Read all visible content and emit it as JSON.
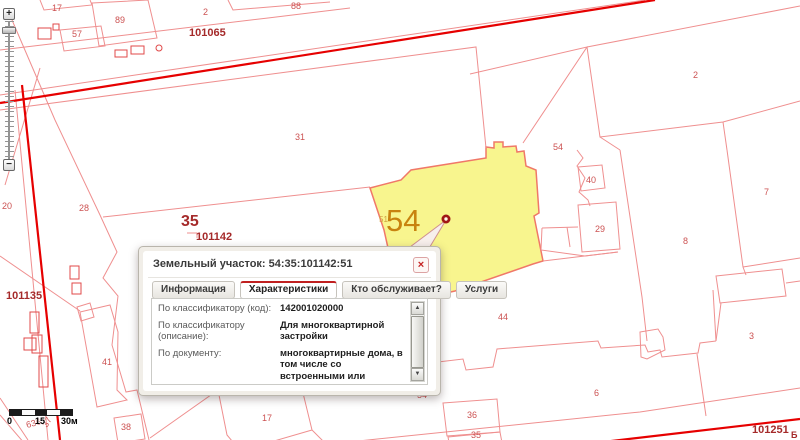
{
  "popup": {
    "title": "Земельный участок: 54:35:101142:51",
    "close_icon": "×",
    "tabs": [
      {
        "label": "Информация",
        "active": false
      },
      {
        "label": "Характеристики",
        "active": true
      },
      {
        "label": "Кто обслуживает?",
        "active": false
      },
      {
        "label": "Услуги",
        "active": false
      }
    ],
    "rows": [
      {
        "label": "По классификатору (код):",
        "value": "142001020000"
      },
      {
        "label": "По классификатору (описание):",
        "value": "Для многоквартирной застройки"
      },
      {
        "label": "По документу:",
        "value": "многоквартирные дома, в том числе со встроенными или встроенно-пристроенными помещениями общественного назначения, автостоянками"
      }
    ],
    "scroll_up_icon": "▲",
    "scroll_down_icon": "▼"
  },
  "zoom_control": {
    "zoom_in_label": "+",
    "zoom_out_label": "−"
  },
  "scale_bar": {
    "start": "0",
    "mid": "15",
    "end": "30м"
  },
  "map": {
    "colors": {
      "parcel_line": "#ef8f8f",
      "building_line": "#e04848",
      "road": "#e60000",
      "selected_fill": "#f8f58e",
      "selected_stroke": "#f07868",
      "marker": "#a01616"
    },
    "selected_parcel_number": "54",
    "labels": [
      {
        "t": "17",
        "x": 52,
        "y": 11,
        "cls": "s"
      },
      {
        "t": "89",
        "x": 115,
        "y": 23,
        "cls": "s"
      },
      {
        "t": "57",
        "x": 72,
        "y": 37,
        "cls": "s"
      },
      {
        "t": "2",
        "x": 203,
        "y": 15,
        "cls": "s"
      },
      {
        "t": "88",
        "x": 291,
        "y": 9,
        "cls": "s"
      },
      {
        "t": "101065",
        "x": 189,
        "y": 36,
        "cls": "q"
      },
      {
        "t": "31",
        "x": 295,
        "y": 140,
        "cls": "s"
      },
      {
        "t": "2",
        "x": 693,
        "y": 78,
        "cls": "s"
      },
      {
        "t": "54",
        "x": 553,
        "y": 150,
        "cls": "s"
      },
      {
        "t": "40",
        "x": 586,
        "y": 183,
        "cls": "s"
      },
      {
        "t": "29",
        "x": 595,
        "y": 232,
        "cls": "s"
      },
      {
        "t": "8",
        "x": 683,
        "y": 244,
        "cls": "s"
      },
      {
        "t": "7",
        "x": 764,
        "y": 195,
        "cls": "s"
      },
      {
        "t": "28",
        "x": 79,
        "y": 211,
        "cls": "s"
      },
      {
        "t": "20",
        "x": 2,
        "y": 209,
        "cls": "s"
      },
      {
        "t": "35",
        "x": 181,
        "y": 226,
        "cls": "q35"
      },
      {
        "t": "101142",
        "x": 196,
        "y": 240,
        "cls": "q"
      },
      {
        "t": "101135",
        "x": 6,
        "y": 299,
        "cls": "q"
      },
      {
        "t": "44",
        "x": 498,
        "y": 320,
        "cls": "s"
      },
      {
        "t": "3",
        "x": 749,
        "y": 339,
        "cls": "s"
      },
      {
        "t": "6",
        "x": 594,
        "y": 396,
        "cls": "s"
      },
      {
        "t": "36",
        "x": 467,
        "y": 418,
        "cls": "s"
      },
      {
        "t": "35",
        "x": 471,
        "y": 438,
        "cls": "s"
      },
      {
        "t": "41",
        "x": 102,
        "y": 365,
        "cls": "s"
      },
      {
        "t": "38",
        "x": 121,
        "y": 430,
        "cls": "s"
      },
      {
        "t": "17",
        "x": 262,
        "y": 421,
        "cls": "s"
      },
      {
        "t": "54",
        "x": 417,
        "y": 398,
        "cls": "s"
      },
      {
        "t": "636",
        "x": 27,
        "y": 428,
        "cls": "s",
        "rot": -15
      },
      {
        "t": "37",
        "x": 47,
        "y": 428,
        "cls": "s",
        "rot": -60
      },
      {
        "t": "101251",
        "x": 752,
        "y": 433,
        "cls": "q"
      },
      {
        "t": "Б",
        "x": 791,
        "y": 438,
        "cls": "tiny"
      },
      {
        "t": "51",
        "x": 379,
        "y": 222,
        "cls": "osmall"
      },
      {
        "t": "54",
        "x": 386,
        "y": 231,
        "cls": "obig"
      }
    ]
  }
}
